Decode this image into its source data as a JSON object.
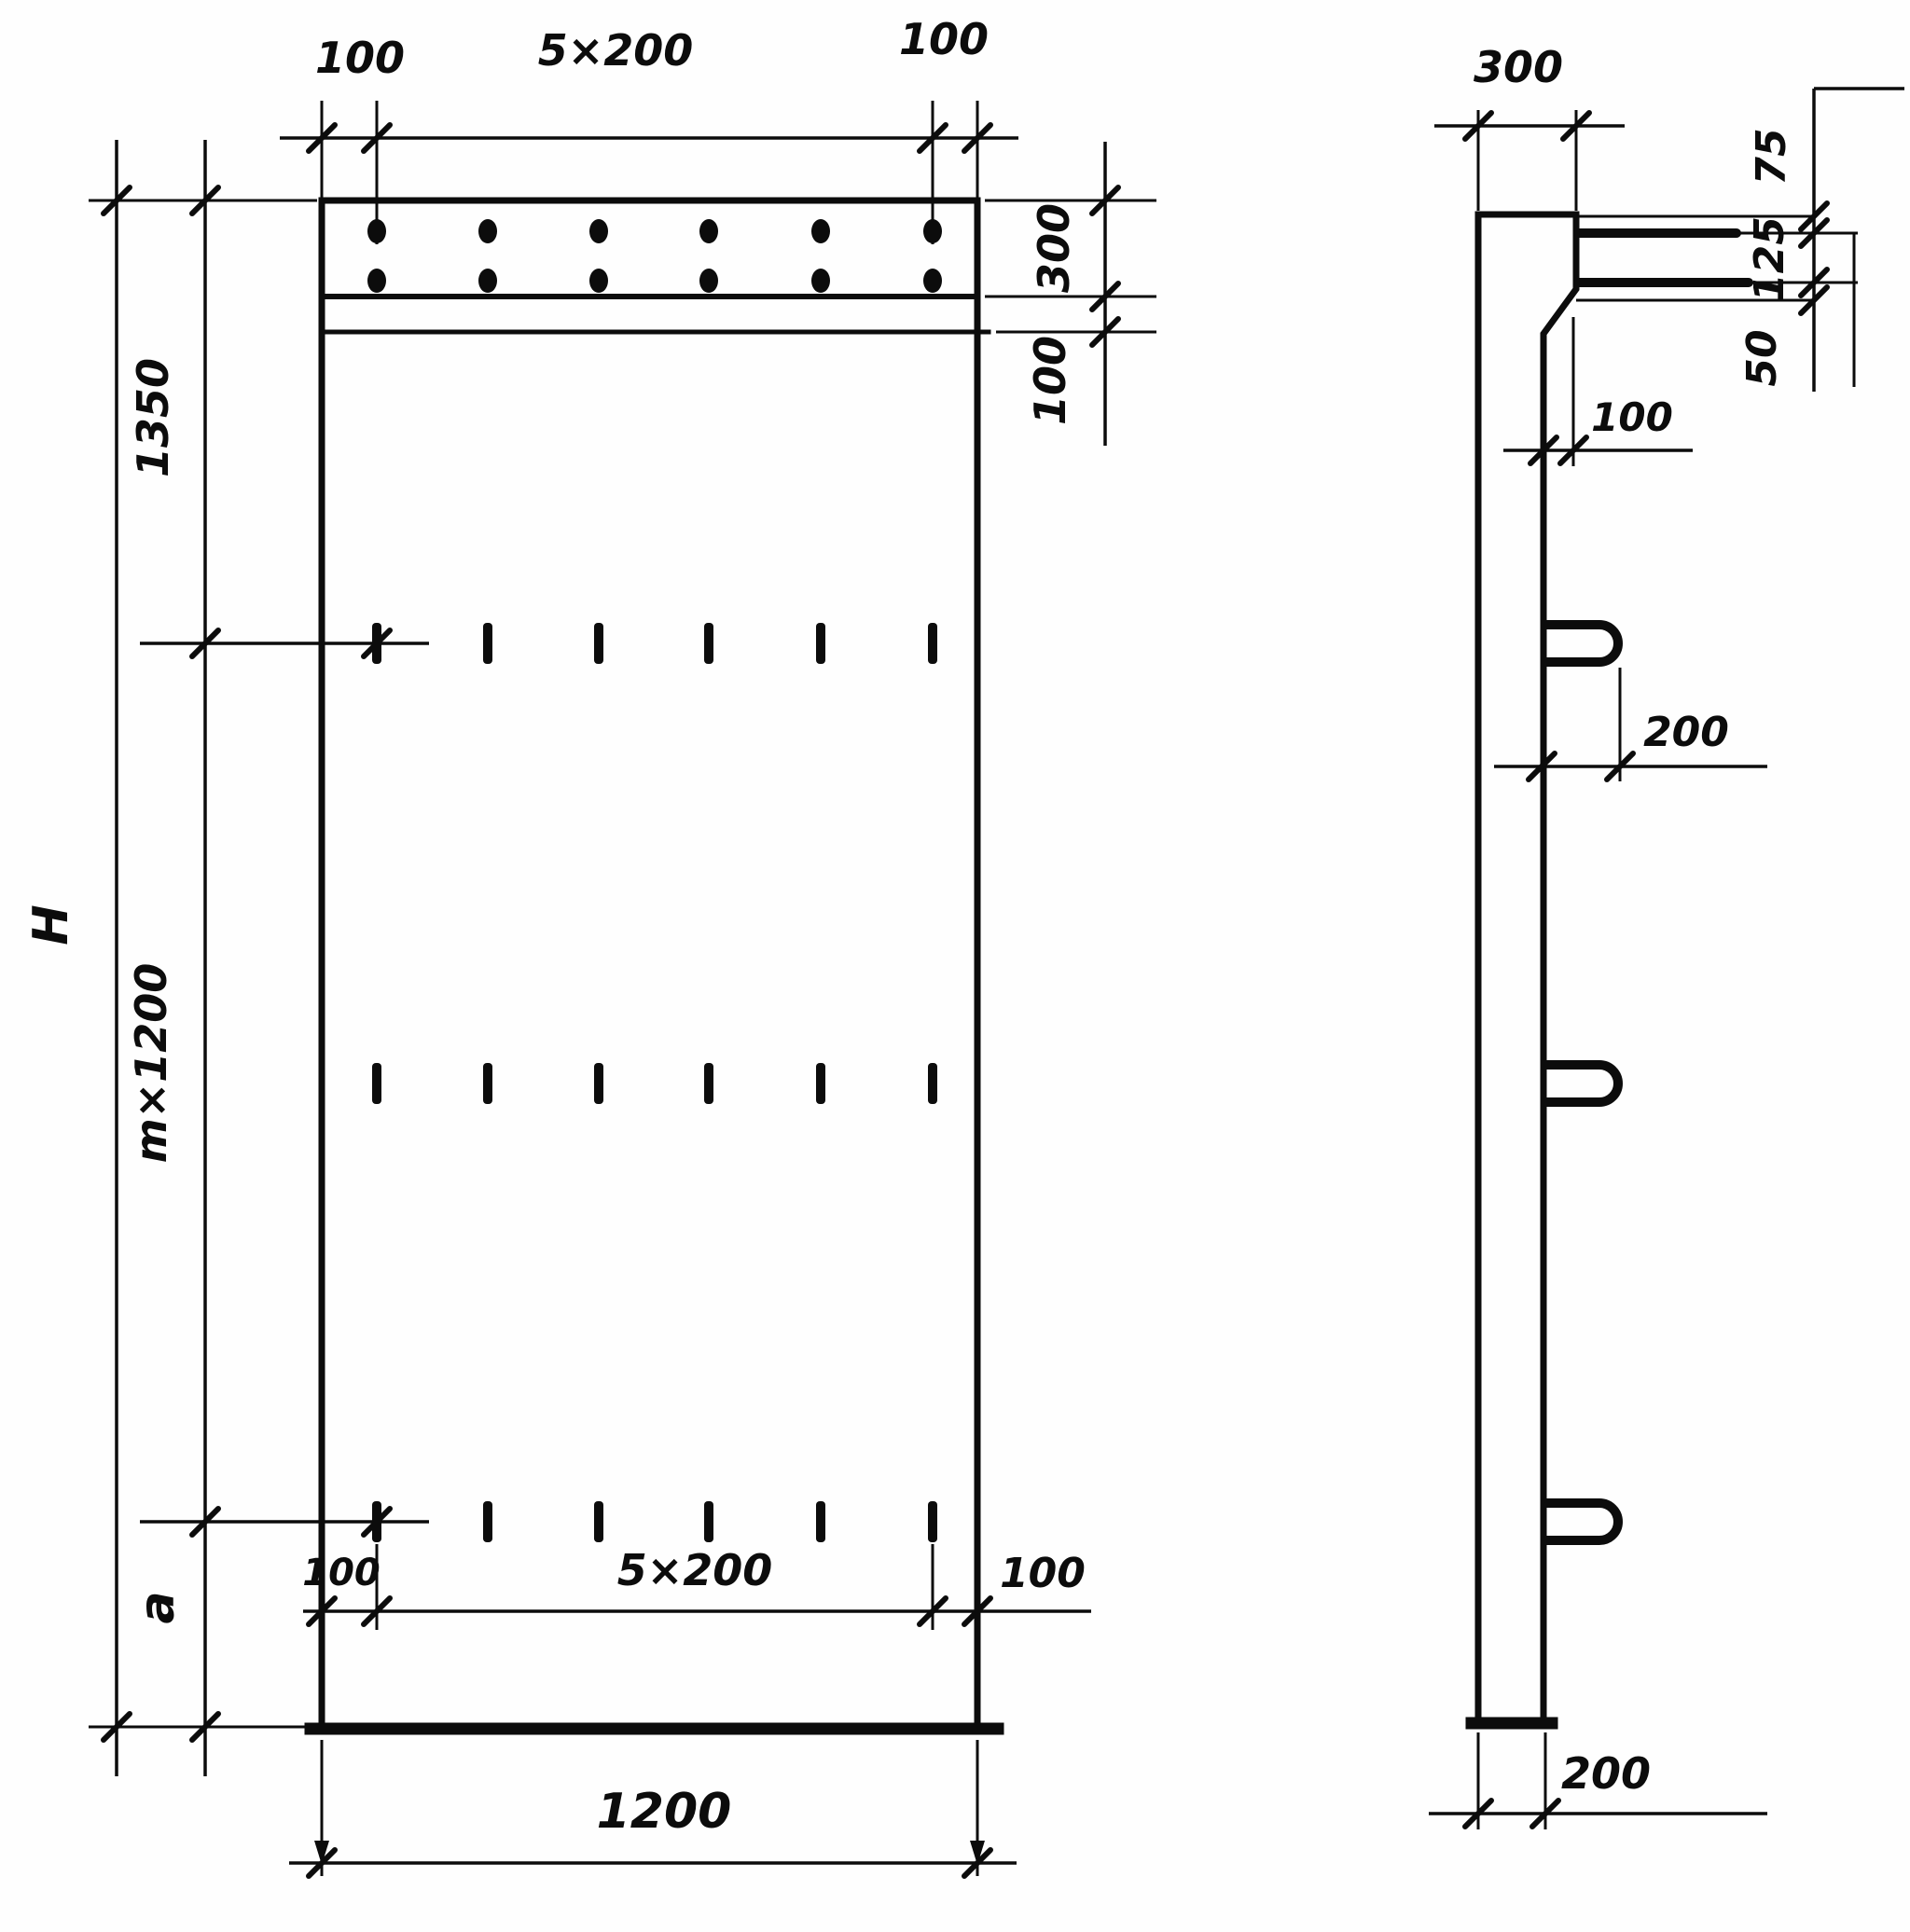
{
  "front_view": {
    "top": {
      "left_offset": "100",
      "spacing": "5×200",
      "right_offset": "100"
    },
    "right": {
      "band_depth": "300",
      "gap": "100"
    },
    "left": {
      "overall_height": "H",
      "top_segment": "1350",
      "middle_segment": "m×1200",
      "bottom_segment": "a"
    },
    "bottom": {
      "left_offset": "100",
      "spacing": "5×200",
      "right_offset": "100",
      "width": "1200"
    }
  },
  "side_view": {
    "top_thickness": "300",
    "bar_offset_first": "75",
    "bar_offset_second": "125",
    "bar_offset_third": "50",
    "step": "100",
    "loop_projection": "200",
    "bottom_thickness": "200"
  }
}
